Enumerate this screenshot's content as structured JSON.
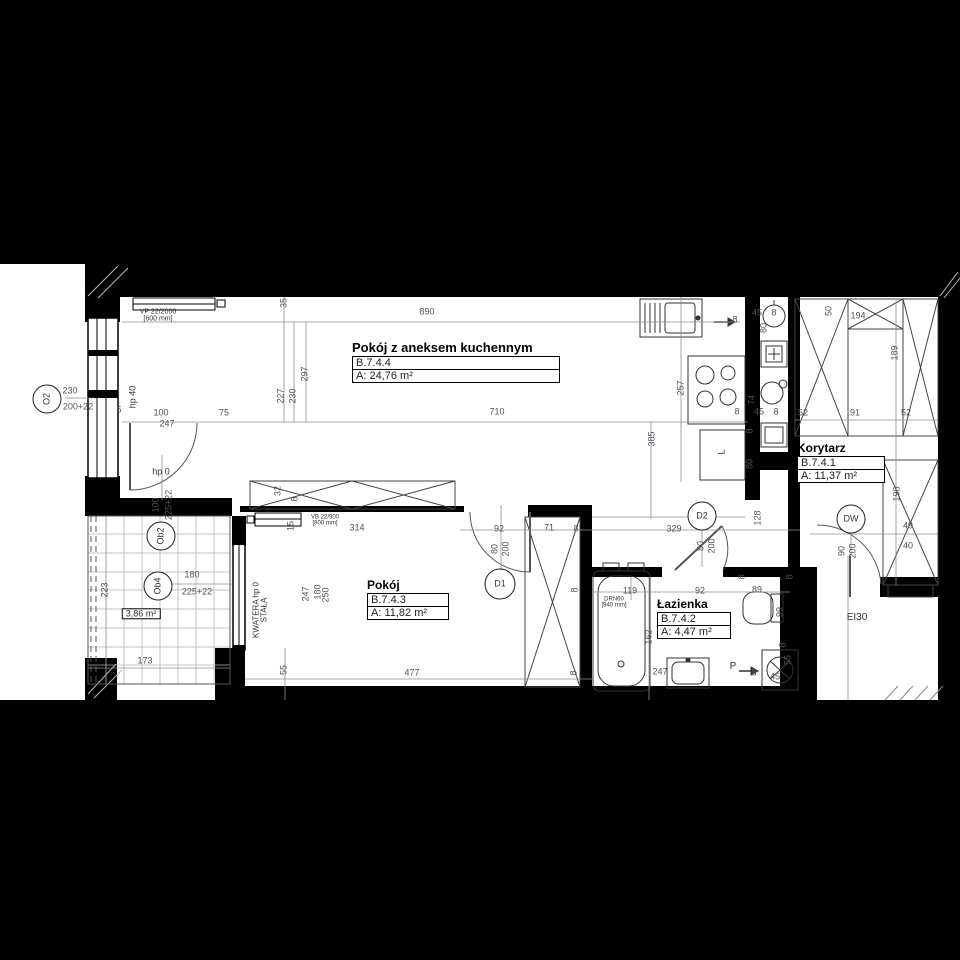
{
  "drawing": {
    "type": "apartment floor plan",
    "colors": {
      "background": "#000000",
      "paper": "#ffffff",
      "walls": "#000000",
      "dimension_text": "#4a5560"
    }
  },
  "rooms": [
    {
      "name": "Pokój z aneksem kuchennym",
      "id": "B.7.4.4",
      "area": "A: 24,76 m²"
    },
    {
      "name": "Pokój",
      "id": "B.7.4.3",
      "area": "A: 11,82 m²"
    },
    {
      "name": "Łazienka",
      "id": "B.7.4.2",
      "area": "A: 4,47 m²"
    },
    {
      "name": "Korytarz",
      "id": "B.7.4.1",
      "area": "A: 11,37 m²"
    }
  ],
  "markers": [
    {
      "t": "O2",
      "x": 47,
      "y": 399,
      "r": 1,
      "d": 27
    },
    {
      "t": "Ob2",
      "x": 161,
      "y": 536,
      "r": 1,
      "d": 27
    },
    {
      "t": "Ob4",
      "x": 158,
      "y": 586,
      "r": 1,
      "d": 27
    },
    {
      "t": "D1",
      "x": 500,
      "y": 584,
      "d": 29
    },
    {
      "t": "D2",
      "x": 702,
      "y": 516,
      "d": 27
    },
    {
      "t": "DW",
      "x": 851,
      "y": 519,
      "d": 27
    }
  ],
  "notes": [
    {
      "t": "VP 22/2000\n[600 mm]",
      "x": 158,
      "y": 316,
      "s": 7
    },
    {
      "t": "VB 22/900\n[800 mm]",
      "x": 325,
      "y": 521,
      "s": 6
    },
    {
      "t": "DRN60\n[940 mm]",
      "x": 614,
      "y": 603,
      "s": 6
    },
    {
      "t": "hp 40",
      "x": 133,
      "y": 397,
      "r": 1,
      "s": 9
    },
    {
      "t": "hp 0",
      "x": 161,
      "y": 472,
      "s": 9
    },
    {
      "t": "KWATERA hp 0\nSTAŁA",
      "x": 261,
      "y": 610,
      "r": 1,
      "s": 8
    },
    {
      "t": "3,86 m²",
      "x": 141,
      "y": 614,
      "box": 1,
      "s": 9
    },
    {
      "t": "EI30",
      "x": 857,
      "y": 618,
      "s": 10
    },
    {
      "t": "P",
      "x": 733,
      "y": 667,
      "s": 10
    },
    {
      "t": "L",
      "x": 722,
      "y": 452,
      "r": 1,
      "s": 9
    }
  ],
  "dims": [
    {
      "t": "890",
      "x": 427,
      "y": 312
    },
    {
      "t": "35",
      "x": 284,
      "y": 303,
      "r": 1
    },
    {
      "t": "297",
      "x": 305,
      "y": 374,
      "r": 1
    },
    {
      "t": "230",
      "x": 293,
      "y": 396,
      "r": 1
    },
    {
      "t": "227",
      "x": 281,
      "y": 396,
      "r": 1
    },
    {
      "t": "710",
      "x": 497,
      "y": 412
    },
    {
      "t": "100",
      "x": 161,
      "y": 413
    },
    {
      "t": "75",
      "x": 224,
      "y": 413
    },
    {
      "t": "247",
      "x": 167,
      "y": 424
    },
    {
      "t": "230",
      "x": 70,
      "y": 391
    },
    {
      "t": "200+22",
      "x": 78,
      "y": 407
    },
    {
      "t": "5",
      "x": 119,
      "y": 410
    },
    {
      "t": "385",
      "x": 652,
      "y": 439,
      "r": 1
    },
    {
      "t": "257",
      "x": 681,
      "y": 388,
      "r": 1
    },
    {
      "t": "8",
      "x": 735,
      "y": 320
    },
    {
      "t": "45",
      "x": 757,
      "y": 313
    },
    {
      "t": "8",
      "x": 774,
      "y": 313
    },
    {
      "t": "80",
      "x": 764,
      "y": 328,
      "r": 1
    },
    {
      "t": "74",
      "x": 752,
      "y": 400,
      "r": 1
    },
    {
      "t": "8",
      "x": 737,
      "y": 412
    },
    {
      "t": "45",
      "x": 759,
      "y": 412
    },
    {
      "t": "8",
      "x": 776,
      "y": 412
    },
    {
      "t": "8",
      "x": 750,
      "y": 431,
      "r": 1
    },
    {
      "t": "80",
      "x": 750,
      "y": 464,
      "r": 1
    },
    {
      "t": "52",
      "x": 803,
      "y": 413
    },
    {
      "t": "91",
      "x": 855,
      "y": 413
    },
    {
      "t": "52",
      "x": 906,
      "y": 413
    },
    {
      "t": "50",
      "x": 829,
      "y": 311,
      "r": 1
    },
    {
      "t": "194",
      "x": 858,
      "y": 316
    },
    {
      "t": "189",
      "x": 895,
      "y": 353,
      "r": 1
    },
    {
      "t": "196",
      "x": 897,
      "y": 494,
      "r": 1
    },
    {
      "t": "49",
      "x": 908,
      "y": 526
    },
    {
      "t": "40",
      "x": 908,
      "y": 546
    },
    {
      "t": "102",
      "x": 853,
      "y": 528
    },
    {
      "t": "90",
      "x": 842,
      "y": 551,
      "r": 1
    },
    {
      "t": "200",
      "x": 853,
      "y": 551,
      "r": 1
    },
    {
      "t": "92",
      "x": 499,
      "y": 529
    },
    {
      "t": "71",
      "x": 549,
      "y": 528
    },
    {
      "t": "8",
      "x": 576,
      "y": 529
    },
    {
      "t": "80",
      "x": 495,
      "y": 549,
      "r": 1
    },
    {
      "t": "200",
      "x": 506,
      "y": 549,
      "r": 1
    },
    {
      "t": "329",
      "x": 674,
      "y": 529
    },
    {
      "t": "128",
      "x": 758,
      "y": 518,
      "r": 1
    },
    {
      "t": "80",
      "x": 701,
      "y": 546,
      "r": 1
    },
    {
      "t": "200",
      "x": 712,
      "y": 546,
      "r": 1
    },
    {
      "t": "92",
      "x": 700,
      "y": 591
    },
    {
      "t": "89",
      "x": 757,
      "y": 590
    },
    {
      "t": "99",
      "x": 780,
      "y": 612,
      "r": 1
    },
    {
      "t": "8",
      "x": 742,
      "y": 577,
      "r": 1
    },
    {
      "t": "8",
      "x": 790,
      "y": 577,
      "r": 1
    },
    {
      "t": "119",
      "x": 630,
      "y": 591
    },
    {
      "t": "162",
      "x": 649,
      "y": 637,
      "r": 1
    },
    {
      "t": "247",
      "x": 660,
      "y": 672
    },
    {
      "t": "8",
      "x": 754,
      "y": 673
    },
    {
      "t": "55",
      "x": 788,
      "y": 660,
      "r": 1
    },
    {
      "t": "45",
      "x": 775,
      "y": 677
    },
    {
      "t": "8",
      "x": 783,
      "y": 645,
      "r": 1
    },
    {
      "t": "314",
      "x": 357,
      "y": 528
    },
    {
      "t": "32",
      "x": 278,
      "y": 491,
      "r": 1
    },
    {
      "t": "8",
      "x": 295,
      "y": 499,
      "r": 1
    },
    {
      "t": "15",
      "x": 291,
      "y": 526,
      "r": 1
    },
    {
      "t": "247",
      "x": 306,
      "y": 594,
      "r": 1
    },
    {
      "t": "180",
      "x": 318,
      "y": 592,
      "r": 1
    },
    {
      "t": "250",
      "x": 326,
      "y": 595,
      "r": 1
    },
    {
      "t": "55",
      "x": 284,
      "y": 670,
      "r": 1
    },
    {
      "t": "477",
      "x": 412,
      "y": 673
    },
    {
      "t": "100",
      "x": 156,
      "y": 505,
      "r": 1
    },
    {
      "t": "225+22",
      "x": 169,
      "y": 505,
      "r": 1
    },
    {
      "t": "180",
      "x": 192,
      "y": 575
    },
    {
      "t": "225+22",
      "x": 197,
      "y": 592
    },
    {
      "t": "223",
      "x": 105,
      "y": 590,
      "r": 1
    },
    {
      "t": "173",
      "x": 145,
      "y": 661
    },
    {
      "t": "8",
      "x": 575,
      "y": 590,
      "r": 1
    },
    {
      "t": "8",
      "x": 574,
      "y": 673,
      "r": 1
    }
  ]
}
